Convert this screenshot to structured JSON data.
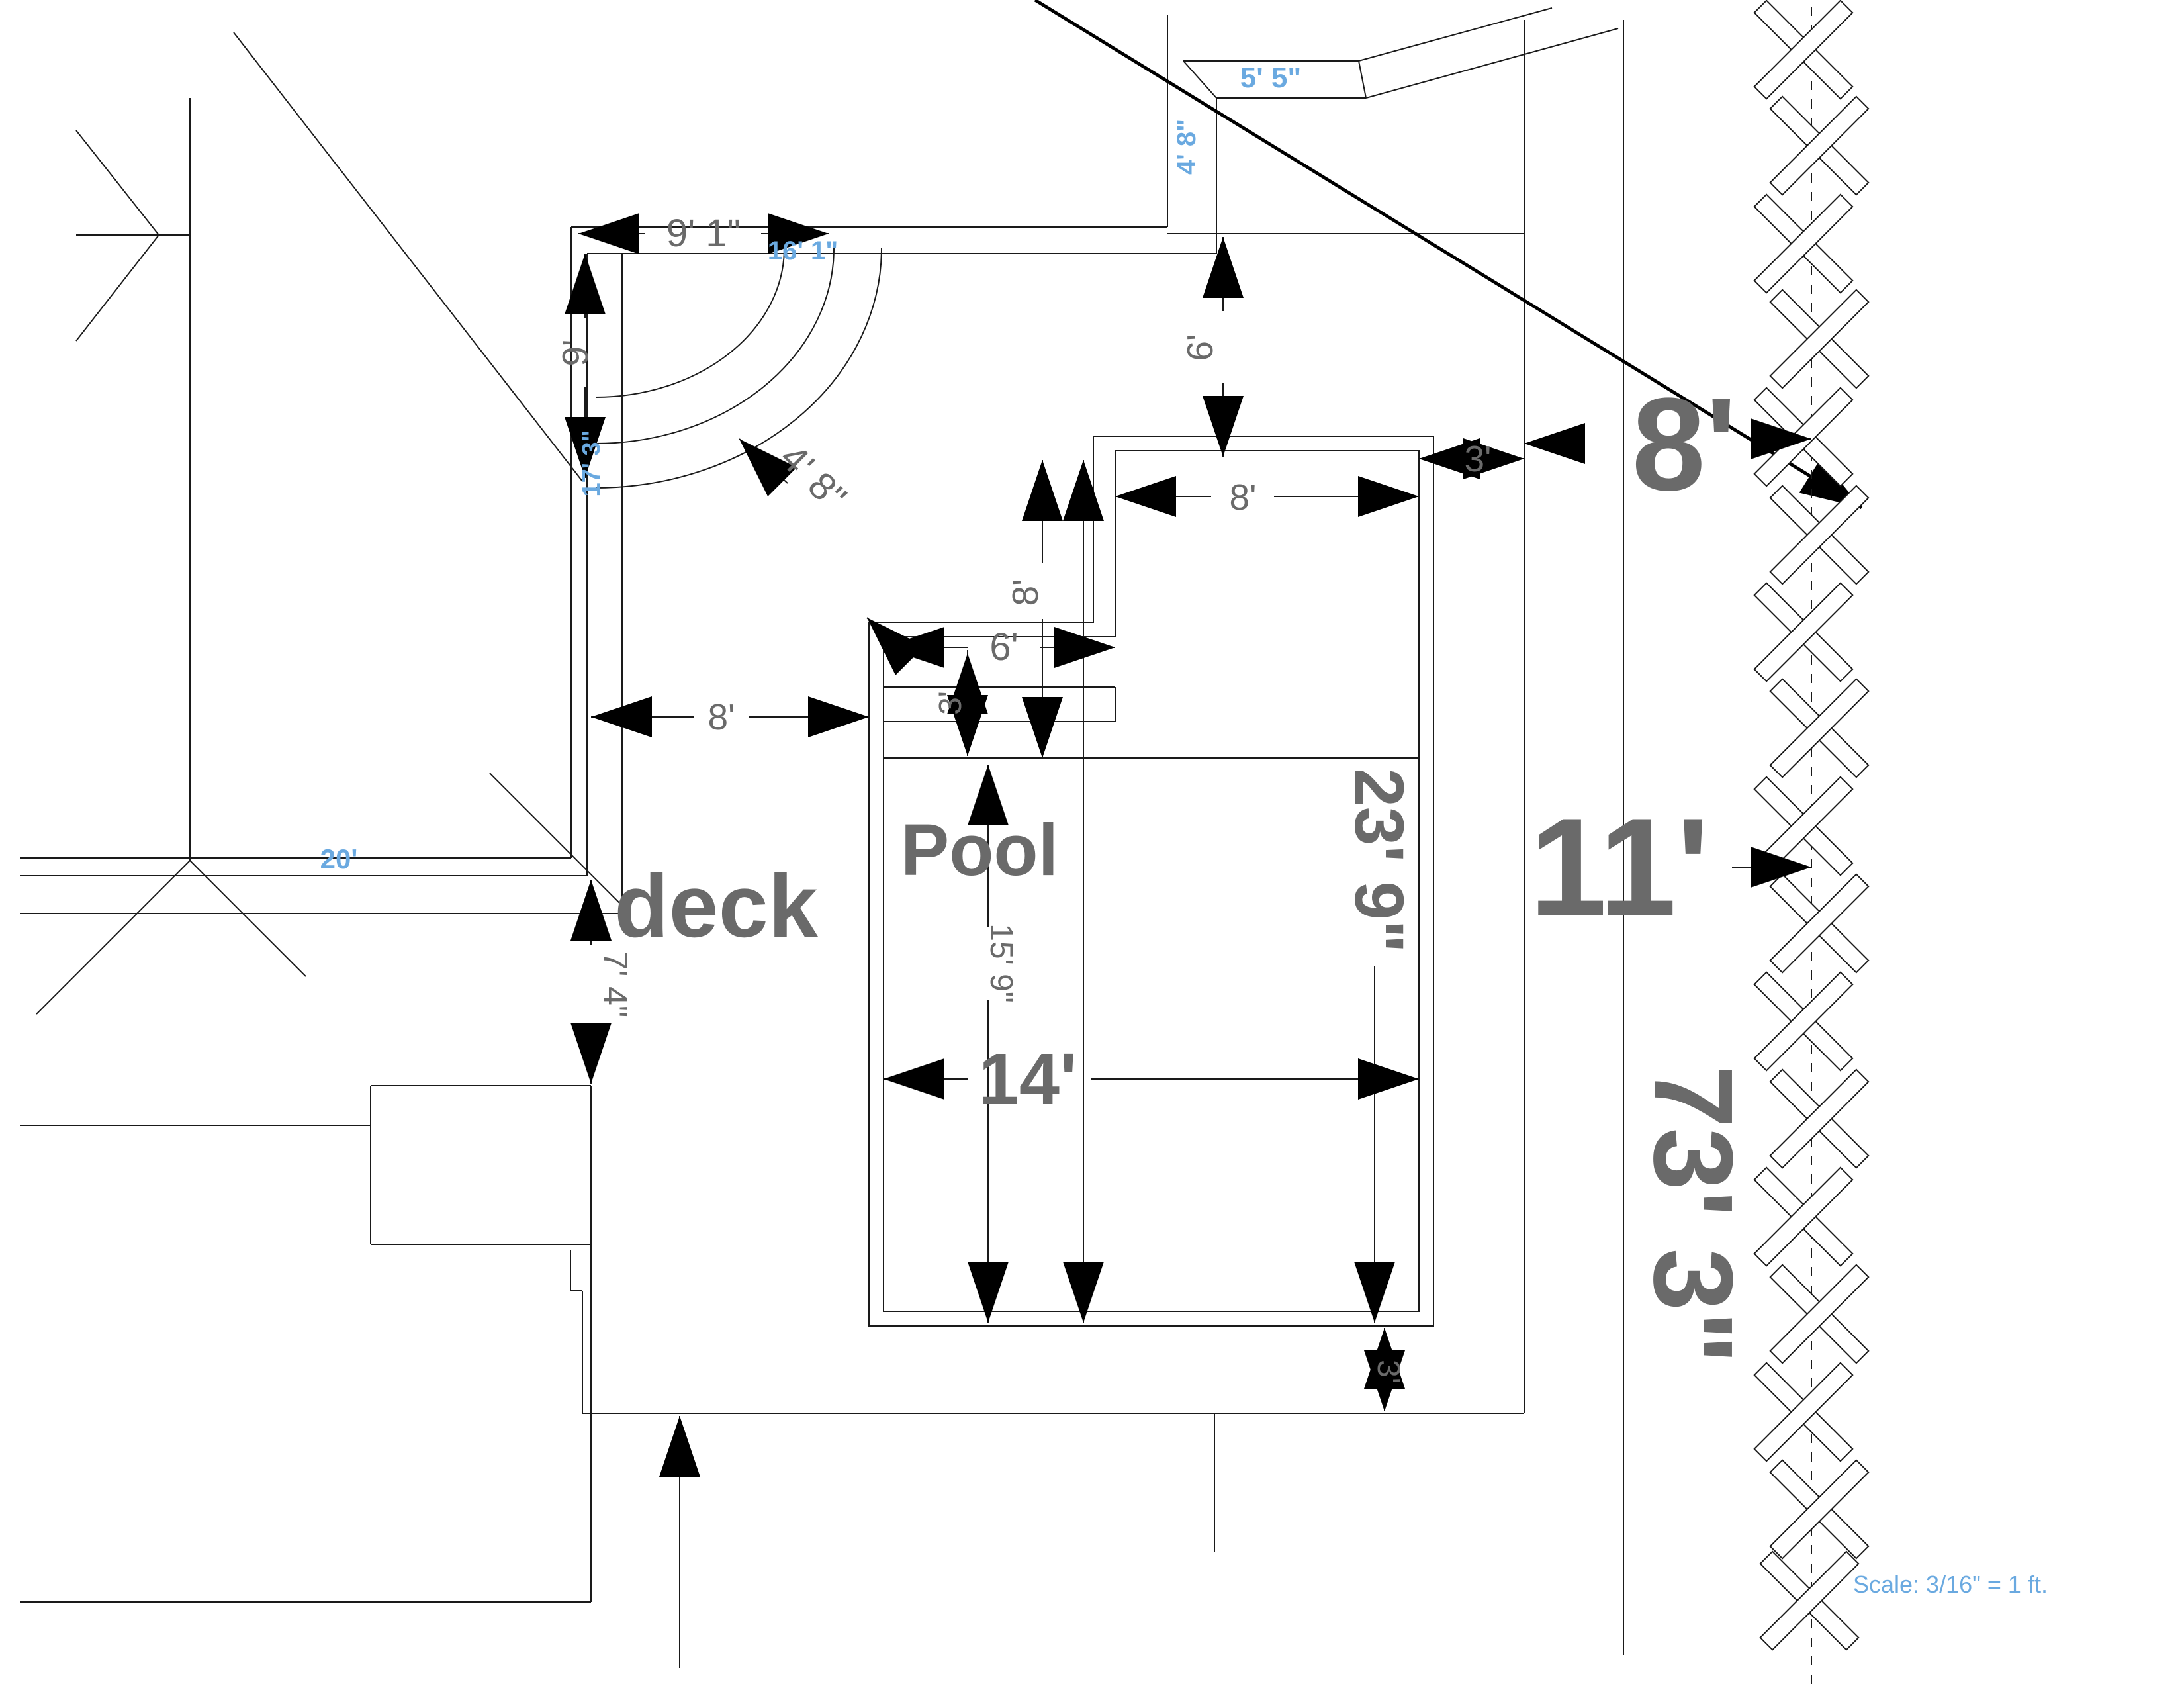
{
  "labels": {
    "pool": "Pool",
    "deck": "deck"
  },
  "dims": {
    "top_width": "9' 1\"",
    "top_width_alt": "16' 1\"",
    "left_depth": "9'",
    "left_depth_alt": "17' 3\"",
    "arc_radius": "4' 8\"",
    "wing_width": "5' 5\"",
    "wing_depth": "4' 8\"",
    "house_to_pool": "6'",
    "spa_width": "8'",
    "spa_depth": "8'",
    "step_width": "6'",
    "step_depth": "3'",
    "deck_to_pool_left": "8'",
    "pool_to_deck_right": "3'",
    "deck_to_fence": "8'",
    "deck_to_fence_mid": "11'",
    "property_depth": "73' 3\"",
    "pool_length": "23' 9\"",
    "pool_inner_length": "15' 9\"",
    "pool_width": "14'",
    "pool_to_deck_bottom": "3'",
    "house_width": "20'",
    "house_to_bay": "7' 4\""
  },
  "scale_note": "Scale: 3/16\" = 1 ft.",
  "colors": {
    "dimension_text": "#6a6a6a",
    "secondary_text": "#6aa9e0",
    "line": "#1a1a1a"
  }
}
